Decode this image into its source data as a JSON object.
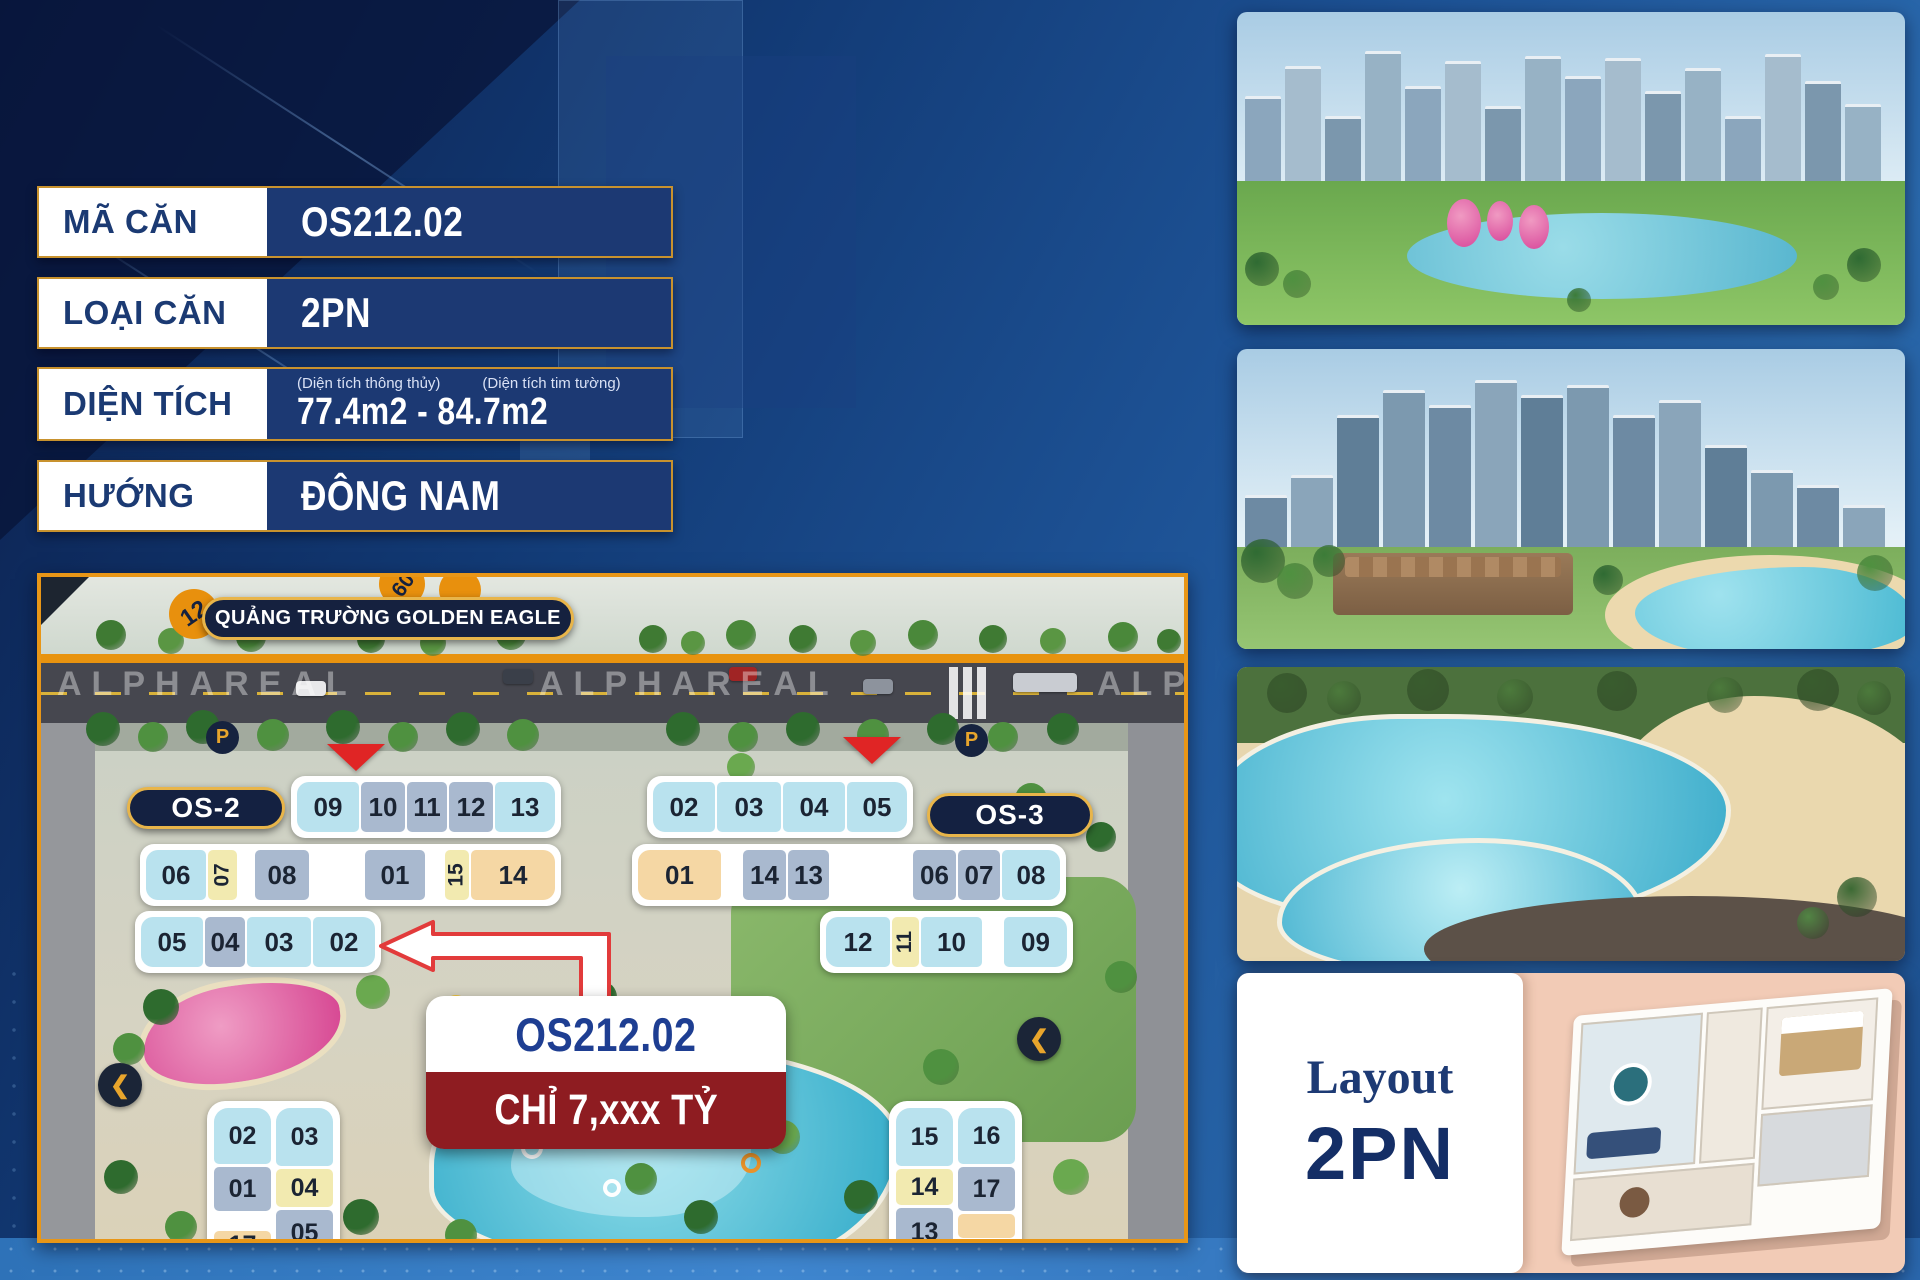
{
  "info_table": {
    "rows": [
      {
        "label": "MÃ CĂN",
        "value": "OS212.02"
      },
      {
        "label": "LOẠI CĂN",
        "value": "2PN"
      },
      {
        "label": "DIỆN TÍCH",
        "value": "77.4m2 - 84.7m2",
        "sub_labels": [
          "(Diện tích thông thủy)",
          "(Diện tích tim tường)"
        ]
      },
      {
        "label": "HƯỚNG",
        "value": "ĐÔNG NAM"
      }
    ]
  },
  "map": {
    "banner": "QUẢNG TRƯỜNG GOLDEN EAGLE",
    "route_marker": "12",
    "secondary_marker": "09",
    "watermark": "ALPHAREAL",
    "parking_label": "P",
    "callout": {
      "unit": "OS212.02",
      "price": "CHỈ 7,xxx TỶ"
    },
    "buildings": [
      {
        "label": "OS-2",
        "pill": {
          "x": 86,
          "y": 210,
          "w": 158,
          "h": 42,
          "fs": 28
        },
        "rows": [
          {
            "x": 250,
            "y": 199,
            "cells": [
              {
                "n": "09",
                "k": "c",
                "w": 62
              },
              {
                "n": "10",
                "k": "b",
                "w": 44
              },
              {
                "n": "11",
                "k": "b",
                "w": 40
              },
              {
                "n": "12",
                "k": "b",
                "w": 44
              },
              {
                "n": "13",
                "k": "c",
                "w": 60
              }
            ]
          },
          {
            "x": 99,
            "y": 267,
            "cells": [
              {
                "n": "06",
                "k": "c",
                "w": 60
              },
              {
                "n": "07",
                "k": "y",
                "w": 29,
                "rot": 1
              },
              {
                "k": "g",
                "w": 14
              },
              {
                "n": "08",
                "k": "b",
                "w": 54
              },
              {
                "k": "g",
                "w": 52
              },
              {
                "n": "01",
                "k": "b",
                "w": 60
              },
              {
                "k": "g",
                "w": 16
              },
              {
                "n": "15",
                "k": "y",
                "w": 24,
                "rot": 1
              },
              {
                "n": "14",
                "k": "t",
                "w": 84
              }
            ]
          },
          {
            "x": 94,
            "y": 334,
            "cells": [
              {
                "n": "05",
                "k": "c",
                "w": 62
              },
              {
                "n": "04",
                "k": "b",
                "w": 40
              },
              {
                "n": "03",
                "k": "c",
                "w": 64
              },
              {
                "n": "02",
                "k": "c",
                "w": 62
              }
            ]
          }
        ]
      },
      {
        "label": "OS-3",
        "pill": {
          "x": 886,
          "y": 216,
          "w": 166,
          "h": 44,
          "fs": 28
        },
        "rows": [
          {
            "x": 606,
            "y": 199,
            "cells": [
              {
                "n": "02",
                "k": "c",
                "w": 62
              },
              {
                "n": "03",
                "k": "c",
                "w": 64
              },
              {
                "n": "04",
                "k": "c",
                "w": 62
              },
              {
                "n": "05",
                "k": "c",
                "w": 60
              }
            ]
          },
          {
            "x": 591,
            "y": 267,
            "cells": [
              {
                "n": "01",
                "k": "t",
                "w": 83
              },
              {
                "k": "g",
                "w": 18
              },
              {
                "n": "14",
                "k": "b",
                "w": 43
              },
              {
                "n": "13",
                "k": "b",
                "w": 41
              },
              {
                "k": "g",
                "w": 80
              },
              {
                "n": "06",
                "k": "b",
                "w": 43
              },
              {
                "n": "07",
                "k": "b",
                "w": 42
              },
              {
                "n": "08",
                "k": "c",
                "w": 58
              }
            ]
          },
          {
            "x": 779,
            "y": 334,
            "cells": [
              {
                "n": "12",
                "k": "c",
                "w": 64
              },
              {
                "n": "11",
                "k": "y",
                "w": 27,
                "rot": 1
              },
              {
                "n": "10",
                "k": "c",
                "w": 61
              },
              {
                "k": "g",
                "w": 18
              },
              {
                "n": "09",
                "k": "c",
                "w": 63
              }
            ]
          }
        ]
      }
    ],
    "stacks": [
      {
        "x": 166,
        "y": 524,
        "cols": [
          {
            "w": 57,
            "cells": [
              {
                "n": "02",
                "k": "c",
                "h": 56
              },
              {
                "n": "01",
                "k": "b",
                "h": 44
              },
              {
                "k": "g",
                "h": 14
              },
              {
                "n": "17",
                "k": "t",
                "h": 28
              }
            ]
          },
          {
            "w": 57,
            "cells": [
              {
                "n": "03",
                "k": "c",
                "h": 58
              },
              {
                "n": "04",
                "k": "y",
                "h": 38
              },
              {
                "n": "05",
                "k": "b",
                "h": 46
              }
            ]
          }
        ]
      },
      {
        "x": 848,
        "y": 524,
        "cols": [
          {
            "w": 57,
            "cells": [
              {
                "n": "15",
                "k": "c",
                "h": 58
              },
              {
                "n": "14",
                "k": "y",
                "h": 36
              },
              {
                "n": "13",
                "k": "b",
                "h": 48
              }
            ]
          },
          {
            "w": 57,
            "cells": [
              {
                "n": "16",
                "k": "c",
                "h": 56
              },
              {
                "n": "17",
                "k": "b",
                "h": 44
              },
              {
                "k": "t",
                "h": 24
              }
            ]
          }
        ]
      }
    ]
  },
  "layout_card": {
    "title": "Layout",
    "type": "2PN"
  },
  "colors": {
    "accent_gold": "#e0a33a",
    "navy_row": "#1c3973",
    "map_border": "#e89617",
    "price_red": "#8e1c21",
    "cell_cyan": "#b9e2ee",
    "cell_bluegray": "#a9b9cf",
    "cell_yellow": "#f2eab0",
    "cell_tan": "#f5d7a4",
    "marker_orange": "#e8900d"
  }
}
